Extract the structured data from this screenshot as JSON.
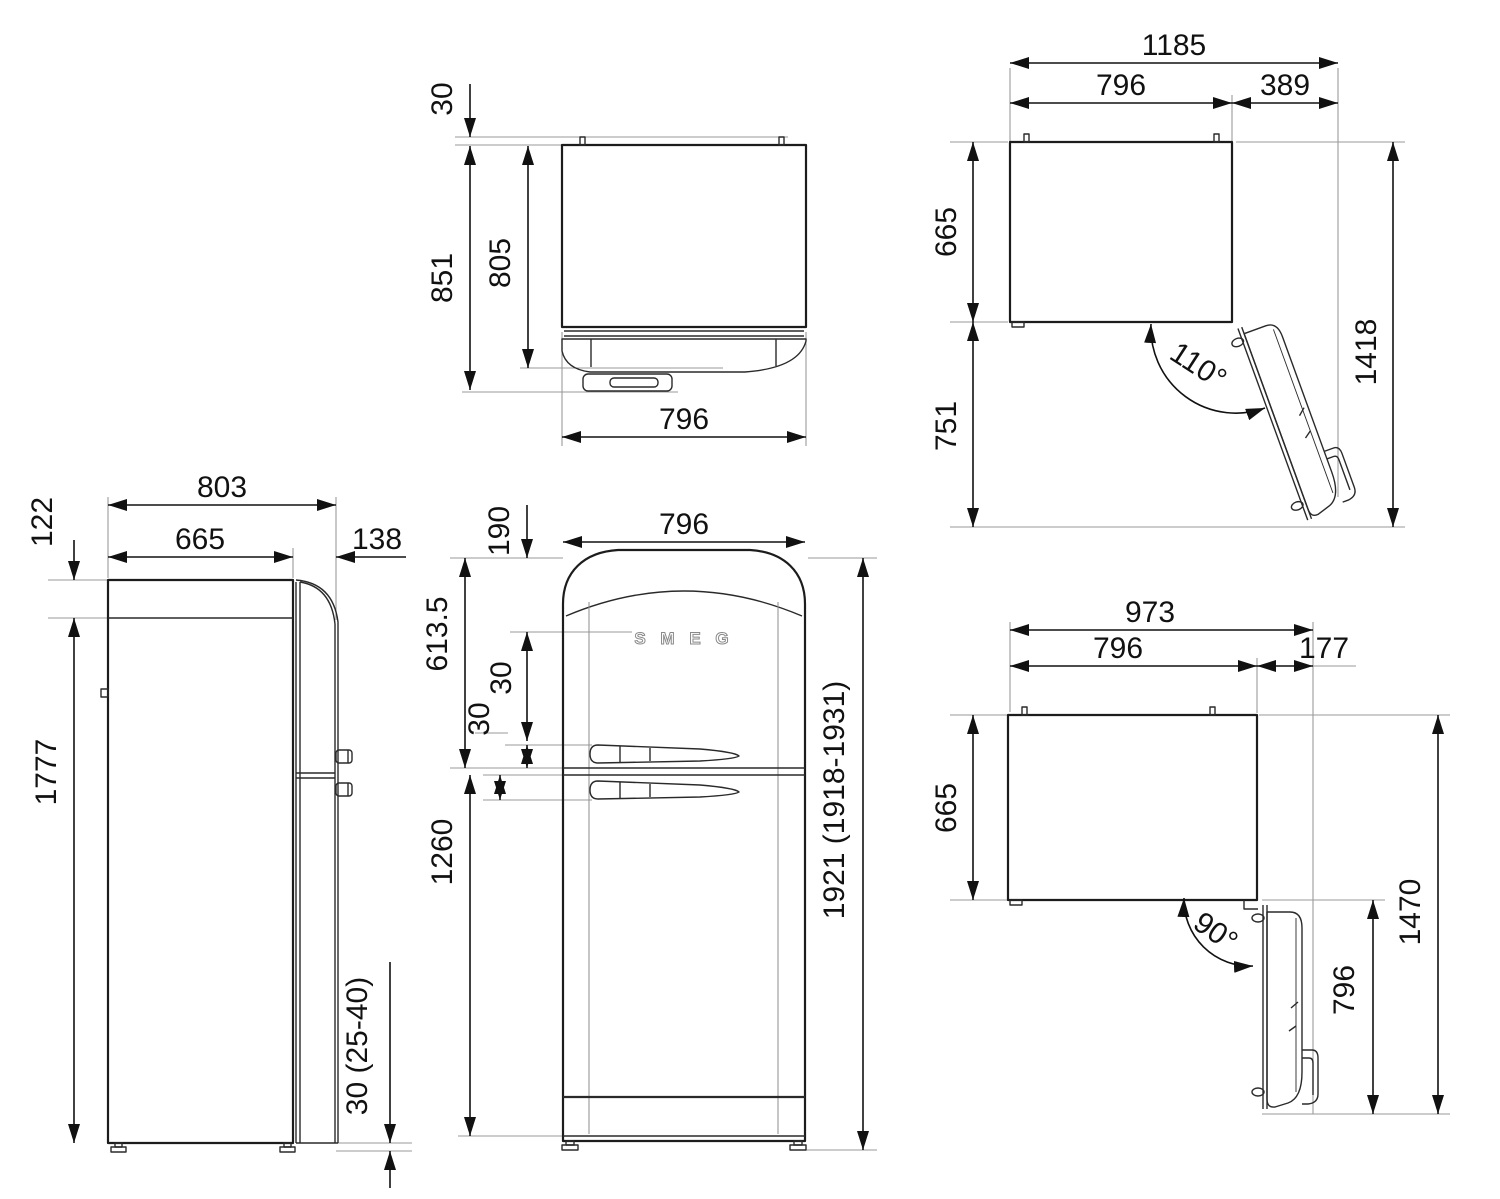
{
  "views": {
    "side": {
      "total_depth": "803",
      "body_depth": "665",
      "door_thickness": "138",
      "top_section": "122",
      "body_height": "1777",
      "floor_gap": "30 (25-40)"
    },
    "top": {
      "rear_clearance": "30",
      "depth_with_handle": "851",
      "depth_to_door": "805",
      "width": "796"
    },
    "door110": {
      "total_width": "1185",
      "body_width": "796",
      "door_extent": "389",
      "body_depth": "665",
      "door_projection": "751",
      "total_depth": "1418",
      "opening_angle": "110°"
    },
    "front": {
      "width": "796",
      "logo_drop": "190",
      "upper_door_height": "613.5",
      "upper_handle_offset": "30",
      "lower_handle_offset": "30",
      "lower_door_height": "1260",
      "total_height": "1921 (1918-1931)",
      "logo": "S M E G"
    },
    "door90": {
      "total_width": "973",
      "body_width": "796",
      "handle_projection": "177",
      "body_depth": "665",
      "total_depth": "1470",
      "door_width": "796",
      "opening_angle": "90°"
    }
  }
}
